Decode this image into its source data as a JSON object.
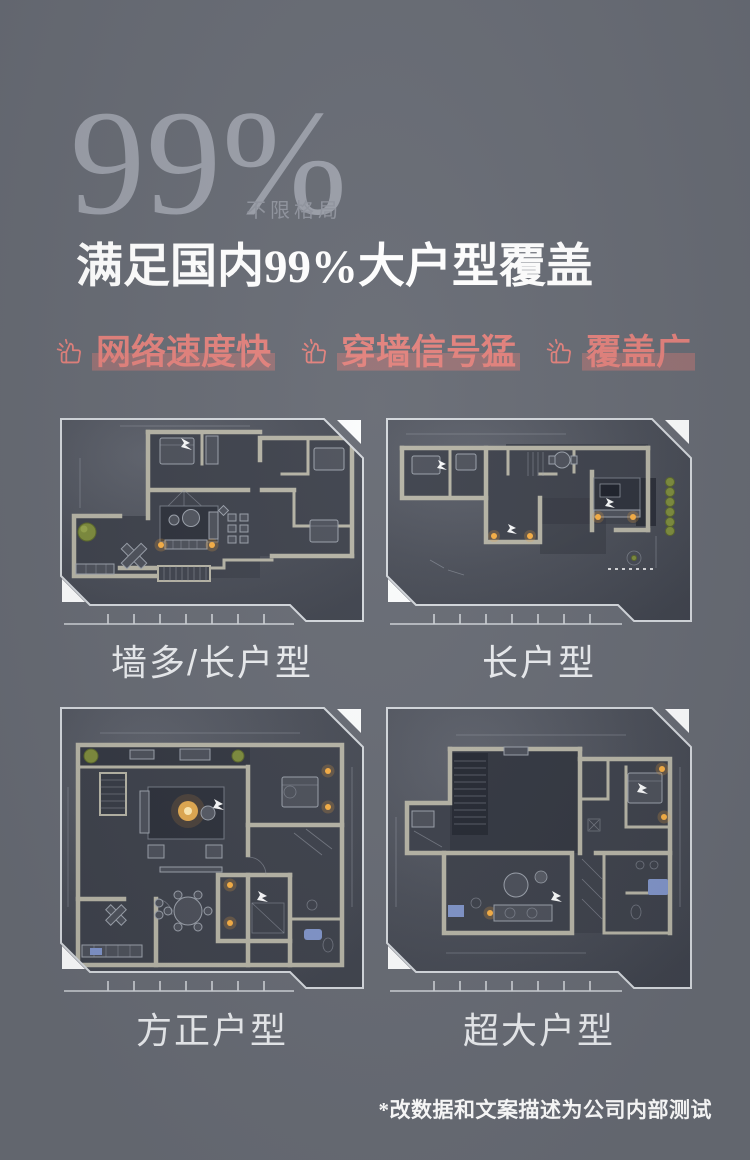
{
  "hero": {
    "percent": "99%",
    "percent_caption": "不限格局",
    "headline": "满足国内99%大户型覆盖"
  },
  "features": [
    {
      "icon": "thumbs-up-sparkle-icon",
      "label": "网络速度快"
    },
    {
      "icon": "thumbs-up-sparkle-icon",
      "label": "穿墙信号猛"
    },
    {
      "icon": "thumbs-up-sparkle-icon",
      "label": "覆盖广"
    }
  ],
  "floorplans": [
    {
      "label": "墙多/长户型"
    },
    {
      "label": "长户型"
    },
    {
      "label": "方正户型"
    },
    {
      "label": "超大户型"
    }
  ],
  "footnote": "*改数据和文案描述为公司内部测试",
  "colors": {
    "page_background": "#676b74",
    "accent_pink": "#e2817c",
    "percent_gray": "#9a9ea8",
    "headline_white": "#ffffff",
    "label_gray": "#e9ebee",
    "wall_beige": "#b5b3a5",
    "light_orange": "#f6ae45",
    "plant_green": "#7d8b3d",
    "frame_line": "#d3d7dc"
  }
}
